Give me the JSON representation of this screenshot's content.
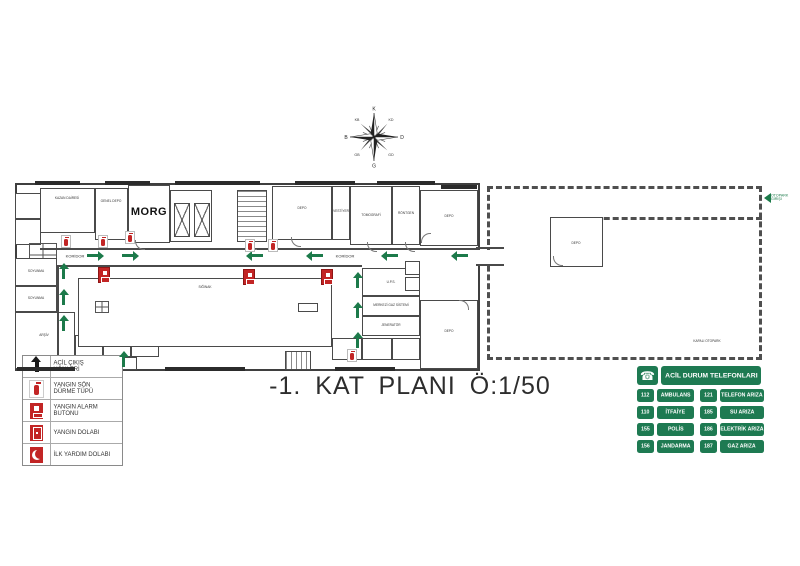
{
  "title": "-1. KAT PLANI Ö:1/50",
  "compass": {
    "labels": [
      "K",
      "KD",
      "D",
      "GD",
      "G",
      "GB",
      "B",
      "KB"
    ]
  },
  "plan": {
    "corridor1": "KORİDOR",
    "corridor2": "KORİDOR",
    "rooms": {
      "kazan": "KAZAN DAİRESİ",
      "genel_depo": "GENEL DEPO",
      "morg": "MORG",
      "depo1": "DEPO",
      "vestiyer": "VESTİYER",
      "tomografi": "TOMOGRAFİ",
      "rontgen": "RÖNTGEN",
      "depo_tr": "DEPO",
      "depo_br": "DEPO",
      "soyunma1": "SOYUNMA",
      "soyunma2": "SOYUNMA",
      "arsiv": "ARŞİV",
      "siginak": "SIĞINAK",
      "ups": "U.P.S.",
      "gaz": "MERKEZİ GAZ SİSTEMİ",
      "jenerator": "JENERATÖR",
      "wing_depo": "DEPO",
      "otopark": "KAPALI OTOPARK"
    },
    "exit_arrow_label": "OTOPARK GİRİŞİ"
  },
  "legend": {
    "items": [
      {
        "icon": "exit-arrow-icon",
        "label": "ACİL ÇIKIŞ YÖNLERİ"
      },
      {
        "icon": "fire-extinguisher-icon",
        "label": "YANGIN SÖN DÜRME TÜPÜ"
      },
      {
        "icon": "fire-alarm-button-icon",
        "label": "YANGIN ALARM BUTONU"
      },
      {
        "icon": "fire-cabinet-icon",
        "label": "YANGIN DOLABI"
      },
      {
        "icon": "first-aid-cabinet-icon",
        "label": "İLK YARDIM DOLABI"
      }
    ]
  },
  "phones": {
    "header": "ACİL DURUM TELEFONLARI",
    "left": [
      {
        "number": "112",
        "label": "AMBULANS"
      },
      {
        "number": "110",
        "label": "İTFAİYE"
      },
      {
        "number": "155",
        "label": "POLİS"
      },
      {
        "number": "156",
        "label": "JANDARMA"
      }
    ],
    "right": [
      {
        "number": "121",
        "label": "TELEFON ARIZA"
      },
      {
        "number": "185",
        "label": "SU ARIZA"
      },
      {
        "number": "186",
        "label": "ELEKTRİK ARIZA"
      },
      {
        "number": "187",
        "label": "GAZ ARIZA"
      }
    ]
  }
}
